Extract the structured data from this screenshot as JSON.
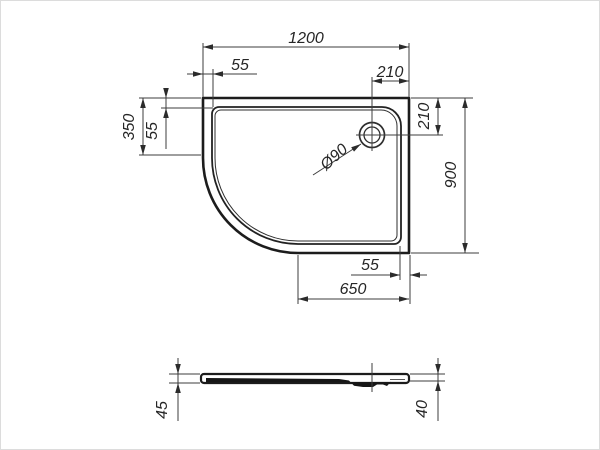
{
  "drawing": {
    "type": "technical-drawing",
    "subject": "offset quadrant shower tray, plan view and side profile"
  },
  "colors": {
    "line": "#1c1c1c",
    "dim_line": "#3d3d3d",
    "text": "#262626",
    "background": "#ffffff"
  },
  "dimensions": {
    "overall_width": "1200",
    "rim_inset_top": "55",
    "drain_offset_from_right": "210",
    "drain_offset_from_top": "210",
    "left_straight_edge": "350",
    "rim_inset_left": "55",
    "overall_depth": "900",
    "rim_inset_bottom": "55",
    "bottom_straight_edge": "650",
    "drain_diameter": "Ø90",
    "profile_height_left": "45",
    "profile_height_right": "40"
  }
}
